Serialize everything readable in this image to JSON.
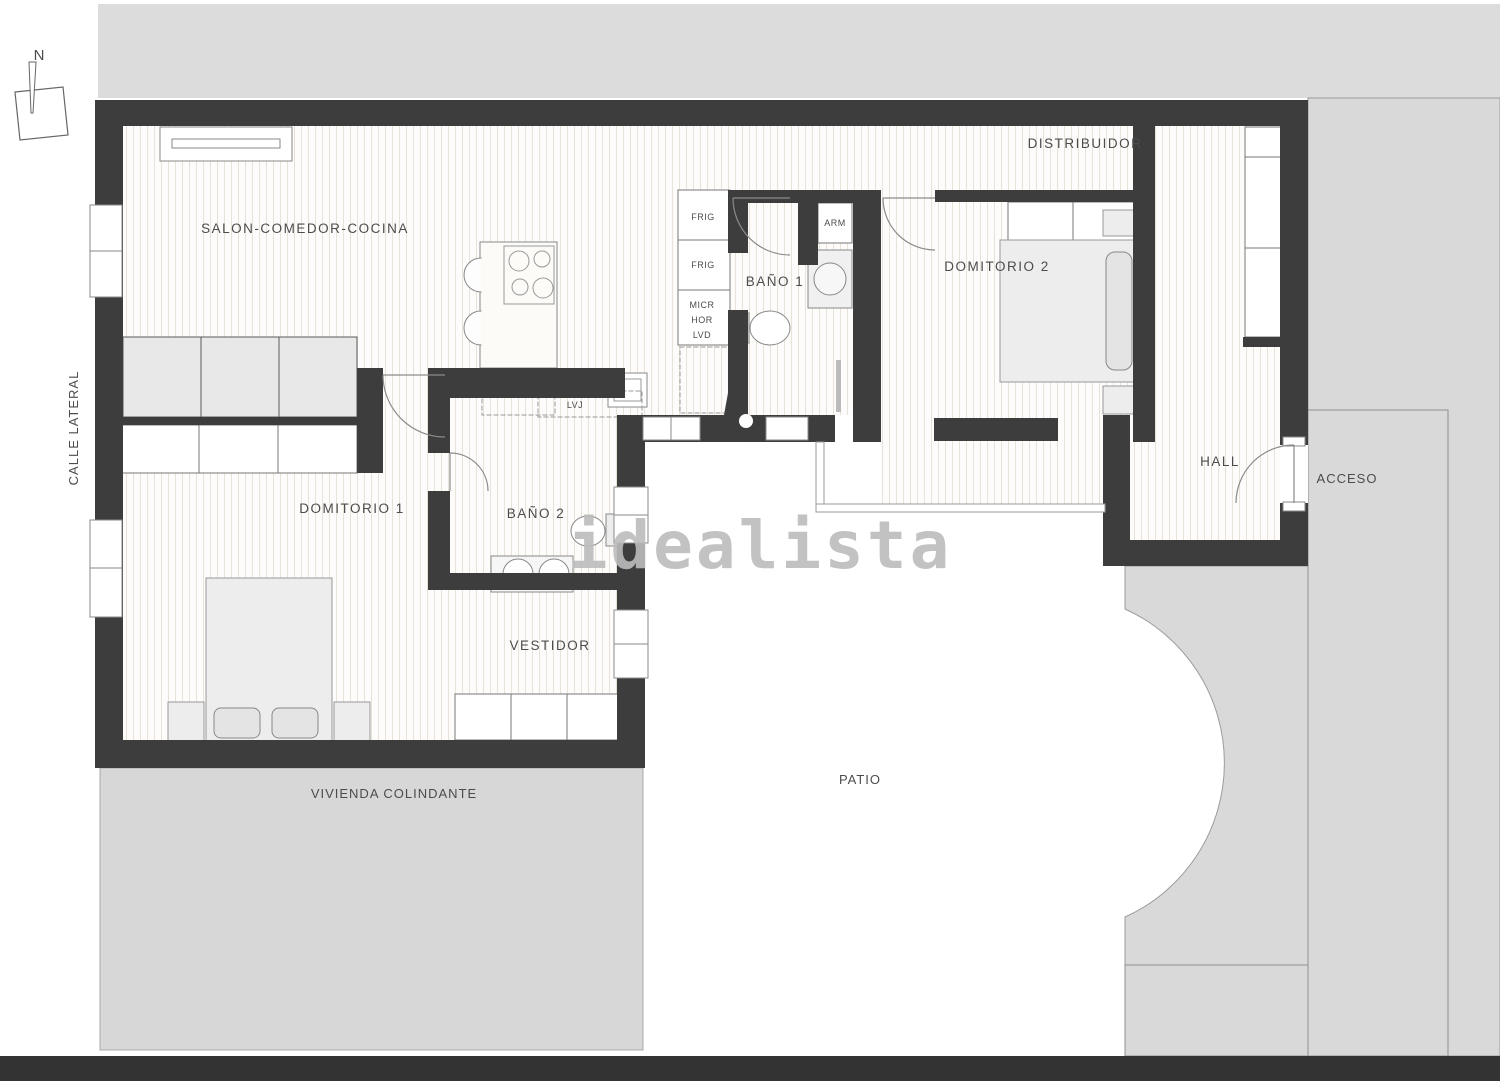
{
  "plan_title": "apartment floor plan",
  "watermark": "idealista",
  "compass": {
    "north_label": "N"
  },
  "rooms": {
    "salon": "SALON-COMEDOR-COCINA",
    "distribuidor": "DISTRIBUIDOR",
    "bano1": "BAÑO 1",
    "dormitorio2": "DOMITORIO 2",
    "dormitorio1": "DOMITORIO 1",
    "bano2": "BAÑO 2",
    "vestidor": "VESTIDOR",
    "hall": "HALL"
  },
  "surroundings": {
    "street_side": "CALLE LATERAL",
    "adjacent_dwelling": "VIVIENDA COLINDANTE",
    "patio": "PATIO",
    "access": "ACCESO"
  },
  "appliances": {
    "fridge_top": "FRIG",
    "fridge_bottom": "FRIG",
    "microwave": "MICR",
    "oven": "HOR",
    "washer": "LVD",
    "dishwasher": "LVJ",
    "wardrobe": "ARM"
  },
  "colors": {
    "wall": "#3d3d3d",
    "mass_gray": "#d9d9d9",
    "floor_stripe": "#e7e3d9",
    "text": "#4c4c4c",
    "watermark": "#bcbcbc",
    "bottom_band": "#333333"
  }
}
